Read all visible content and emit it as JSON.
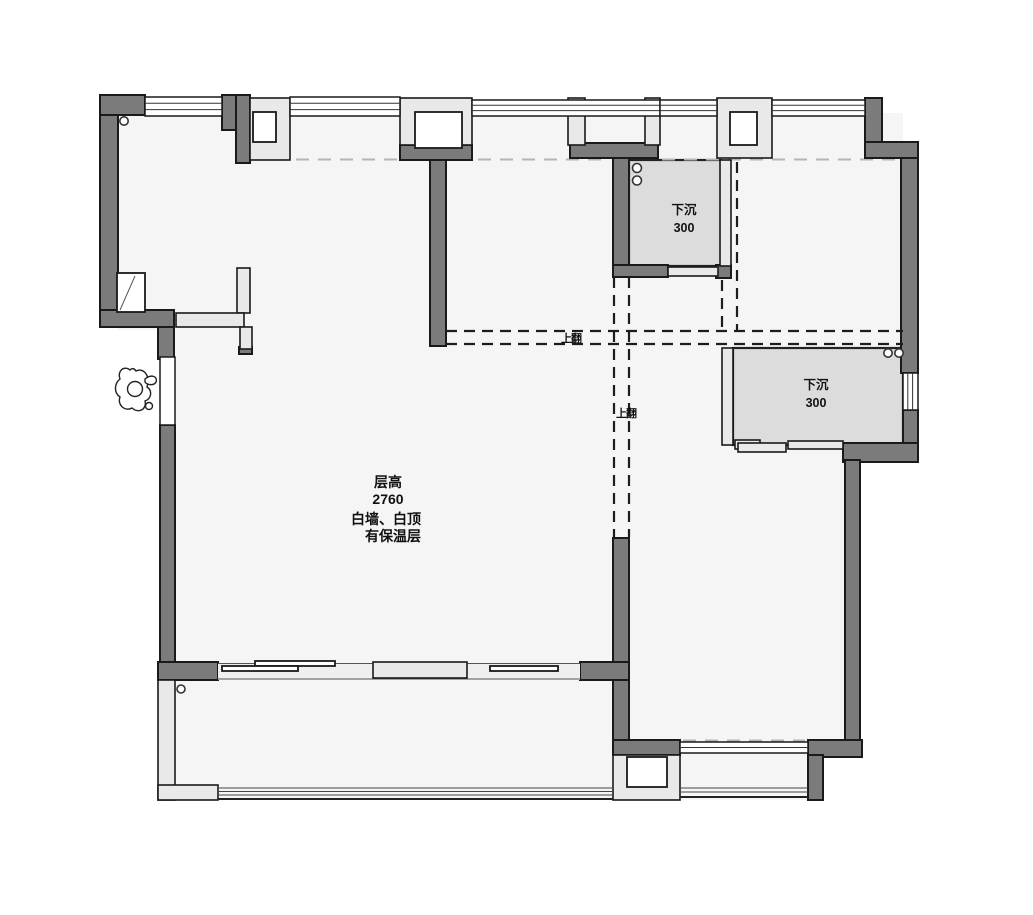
{
  "colors": {
    "background": "#ffffff",
    "floor": "#f5f5f5",
    "wall_dark": "#7b7b7b",
    "wall_light": "#e9e9e9",
    "sunken_fill": "#dcdcdc",
    "outline": "#1a1a1a",
    "dash": "#1d1d1d"
  },
  "labels": {
    "floor_height": {
      "line1": "层高",
      "line2": "2760"
    },
    "wall_note": {
      "line1": "白墙、白顶",
      "line2": "有保温层"
    }
  },
  "sunken_areas": [
    {
      "title": "下沉",
      "value": "300"
    },
    {
      "title": "下沉",
      "value": "300"
    }
  ],
  "beam_labels": [
    {
      "text": "上翻"
    },
    {
      "text": "上翻"
    }
  ]
}
